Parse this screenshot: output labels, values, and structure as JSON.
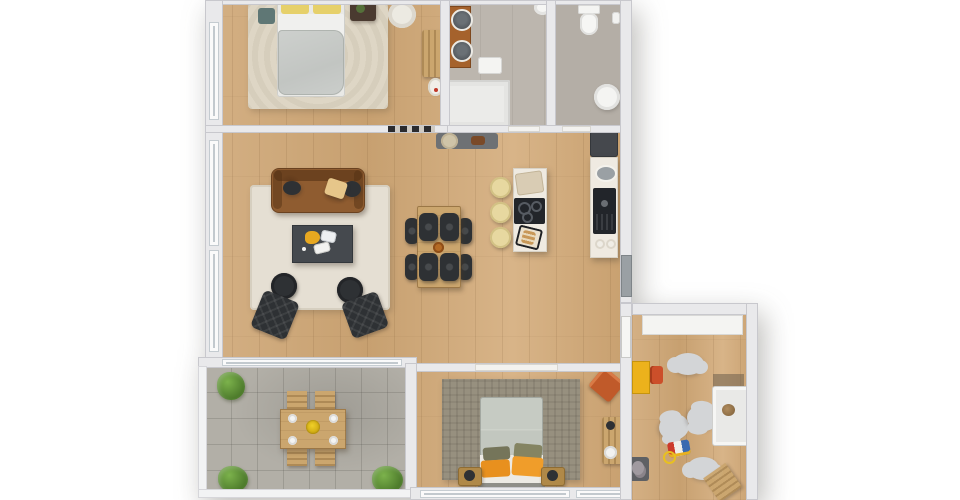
{
  "meta": {
    "view": "3d-top-down-floor-plan",
    "width_px": 960,
    "height_px": 500,
    "visible_text": ""
  },
  "palette": {
    "page-bg": "#ffffff",
    "wood": "#cfab7e",
    "wall": "#e9e9eb",
    "tile": "#bcb6ae",
    "tile2": "#b4aea6",
    "stone": "#b2afa7",
    "rug-cream": "#ded6c5",
    "rug-living": "#e5dfd3",
    "rug-gray": "#97907f",
    "sofa": "#8f5c30",
    "coffee-table": "#45494e",
    "dark-furniture": "#2e3134",
    "table-wood": "#cba66e",
    "island": "#efeae1",
    "cooktop": "#22252a",
    "stool": "#e7d8a0",
    "vanity": "#a5622c",
    "nstand": "#b08948",
    "cloud": "#d3d5d7",
    "door-gray": "#9aa0a4",
    "accent-yellow": "#ecb21c",
    "accent-orange": "#e8901e",
    "accent-terracotta": "#c05a2a",
    "pillow-yellow": "#e6d06a",
    "pillow-olive": "#75755a",
    "plant-green": "#5e8c34"
  },
  "rooms": [
    {
      "name": "bedroom-1",
      "floor": "wood",
      "furniture": [
        "double-bed",
        "yellow-pillows",
        "cream-area-rug",
        "teal-stool",
        "dark-nightstand-with-plant",
        "white-armchair",
        "ladder-shelf",
        "laundry-basket"
      ]
    },
    {
      "name": "bathroom-main",
      "floor": "tile",
      "furniture": [
        "wood-vanity-two-basins",
        "walk-in-shower",
        "bath-mat",
        "ceiling-lamp",
        "wall-mirror",
        "entry-mat-with-round-rug"
      ]
    },
    {
      "name": "bathroom-guest",
      "floor": "tile",
      "furniture": [
        "toilet",
        "corner-sink",
        "paper-holder"
      ]
    },
    {
      "name": "living-room",
      "floor": "wood",
      "furniture": [
        "leather-sofa",
        "two-dark-cushions",
        "cream-blanket",
        "coffee-table-with-tray",
        "two-round-poufs",
        "two-tufted-lounge-chairs",
        "cream-area-rug"
      ]
    },
    {
      "name": "dining-area",
      "floor": "wood",
      "furniture": [
        "wood-dining-table",
        "four-dark-chairs",
        "small-bowl"
      ]
    },
    {
      "name": "kitchen",
      "floor": "wood",
      "furniture": [
        "island-with-cooktop",
        "serving-tray",
        "bread-board",
        "three-cream-stools",
        "wall-counter",
        "oval-sink",
        "oven",
        "refrigerator",
        "entrance-door"
      ]
    },
    {
      "name": "terrace",
      "floor": "stone",
      "furniture": [
        "outdoor-wood-table",
        "four-wood-chairs",
        "four-plates",
        "yellow-centerpiece",
        "three-plants"
      ]
    },
    {
      "name": "bedroom-2",
      "floor": "wood",
      "furniture": [
        "double-bed-gray",
        "olive-and-orange-pillows",
        "gray-area-rug",
        "two-nightstands-with-lamps",
        "terracotta-accent-chair",
        "wood-desk",
        "white-stool",
        "sliding-door"
      ]
    },
    {
      "name": "kids-room",
      "floor": "wood",
      "furniture": [
        "white-wardrobe",
        "yellow-cabinet",
        "red-kids-chair",
        "four-cloud-rugs",
        "white-crib-with-teddy",
        "toy-train",
        "play-mat-with-plush",
        "wooden-high-chair",
        "door"
      ]
    }
  ]
}
